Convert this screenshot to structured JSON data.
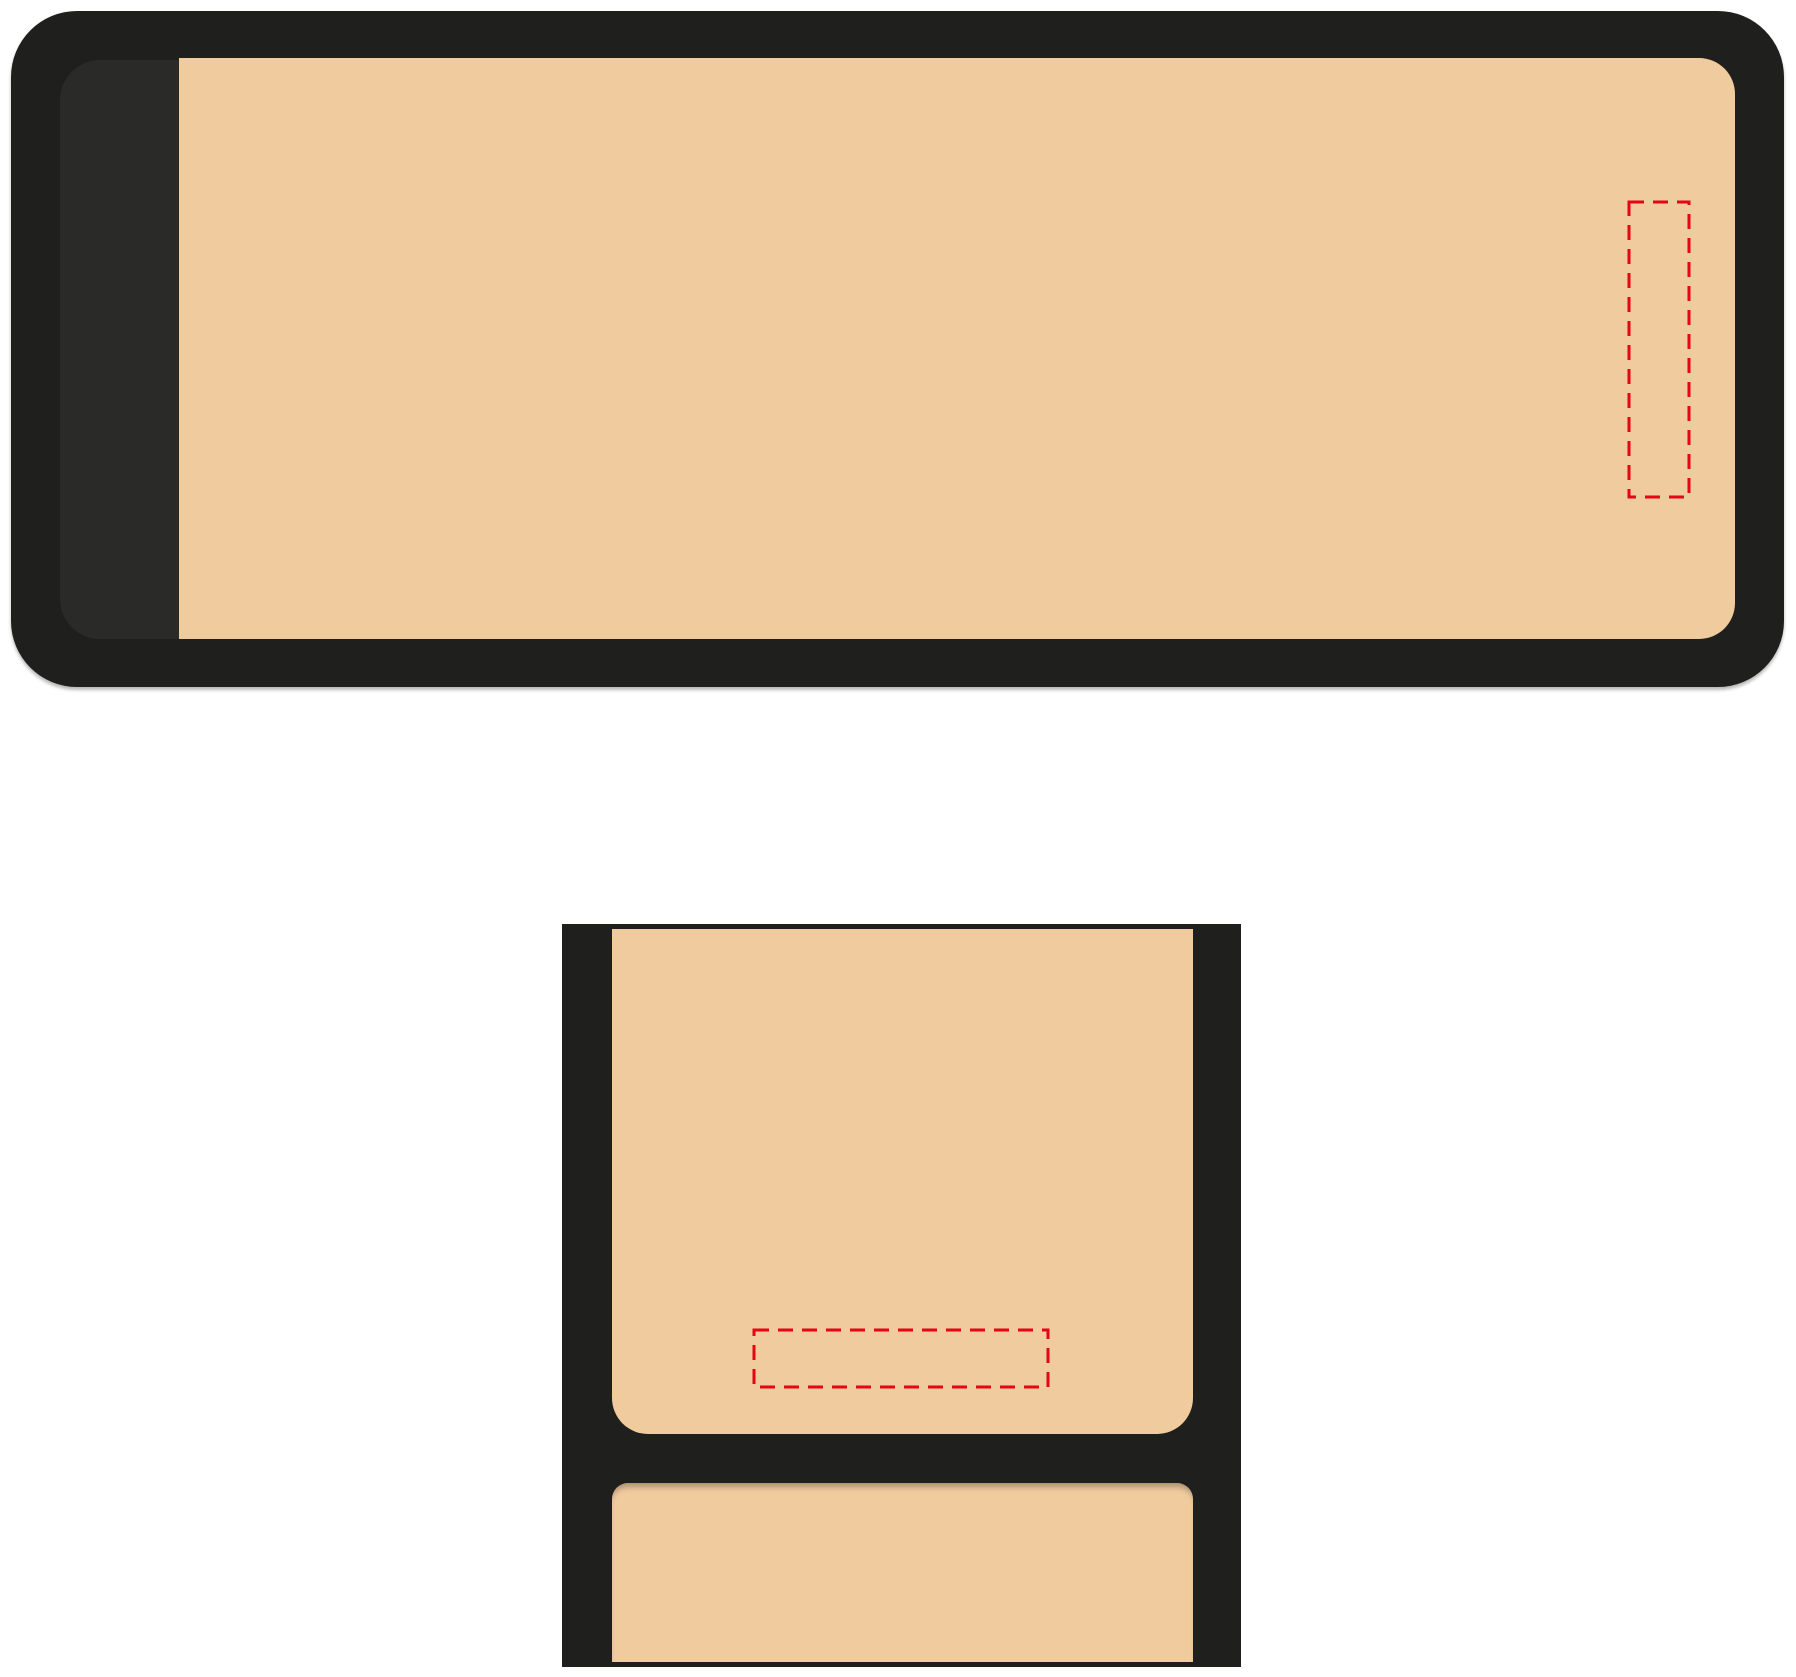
{
  "canvas": {
    "width": 1796,
    "height": 1677,
    "background": "#ffffff"
  },
  "colors": {
    "canvas_bg": "#ffffff",
    "shell_black": "#1f1f1d",
    "lining_black": "#2a2a28",
    "fabric_tan": "#f0cb9d",
    "print_area_red": "#e30613"
  },
  "dash_style": {
    "dasharray": "15 9",
    "stroke_width": 3
  },
  "views": {
    "top_view": {
      "outer": {
        "x": 11,
        "y": 11,
        "w": 1773,
        "h": 676
      },
      "lining": {
        "x": 60,
        "y": 60,
        "w": 1675,
        "h": 579
      },
      "panel": {
        "x": 179,
        "y": 58,
        "w": 1556,
        "h": 581
      },
      "print_area": {
        "x": 1629,
        "y": 202,
        "w": 60,
        "h": 295
      }
    },
    "front_view": {
      "outer": {
        "x": 562,
        "y": 924,
        "w": 679,
        "h": 743
      },
      "flap_panel": {
        "x": 612,
        "y": 929,
        "w": 581,
        "h": 505
      },
      "body_panel": {
        "x": 612,
        "y": 1483,
        "w": 581,
        "h": 179
      },
      "print_area": {
        "x": 754,
        "y": 1330,
        "w": 294,
        "h": 57
      }
    }
  }
}
